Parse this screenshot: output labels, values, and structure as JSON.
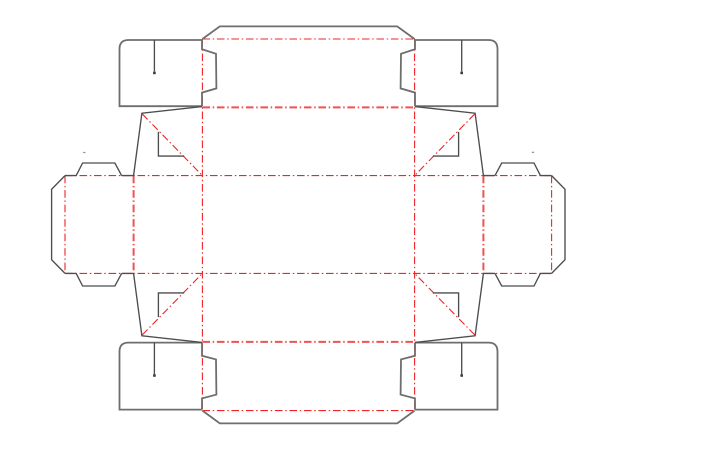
{
  "canvas": {
    "width": 720,
    "height": 464,
    "background": "#ffffff"
  },
  "styles": {
    "cut_color": "#4d4d4d",
    "cut_width": 1.35,
    "heavy_cut_color": "#6e6e6e",
    "heavy_cut_width": 1.8,
    "fold_color": "#f02427",
    "fold_width": 1.1,
    "fold_bold_width": 2.0,
    "fold_bold_opacity": 0.8,
    "fold_dash": "7.6 2.7 1.5 2.7",
    "dot_color": "#3a3a3a",
    "mark_color": "#8a8a8a"
  },
  "dieline": {
    "cut_paths": [
      {
        "name": "top-lid-flap",
        "heavy": true,
        "d": "M 202.4 39 L 219.8 26.4 L 397.2 26.4 L 414.6 39"
      },
      {
        "name": "bottom-lid-flap",
        "heavy": true,
        "d": "M 202.4 410.6 L 219.8 423.4 L 397.2 423.4 L 414.6 410.6"
      },
      {
        "name": "top-left-tuck-flap",
        "heavy": true,
        "d": "M 202 40 L 128.5 40 Q 119.5 40 119.5 49 L 119.5 106.2 L 202 106.2 M 202 40 L 202 49.2 L 216 53.8 L 216.4 88.4 L 202 92.6 L 202 106.2"
      },
      {
        "name": "top-left-flap-slit",
        "d": "M 154.4 40 L 154.4 71.4"
      },
      {
        "name": "top-right-tuck-flap",
        "heavy": true,
        "d": "M 415 40 L 488.5 40 Q 497.5 40 497.5 49 L 497.5 106.2 L 415 106.2 M 415 40 L 415 49.2 L 401 53.8 L 400.6 88.4 L 415 92.6 L 415 106.2"
      },
      {
        "name": "top-right-flap-slit",
        "d": "M 461.7 40 L 461.7 71.4"
      },
      {
        "name": "bottom-left-tuck-flap",
        "heavy": true,
        "d": "M 202 342.6 L 128.5 342.6 Q 119.5 342.6 119.5 351.6 L 119.5 409.6 L 202 409.6 M 202 342.6 L 202 355.8 L 216 359.4 L 216.4 394.6 L 202 398.4 L 202 409.6"
      },
      {
        "name": "bottom-left-flap-slit",
        "d": "M 154.4 342.6 L 154.4 374.2"
      },
      {
        "name": "bottom-right-tuck-flap",
        "heavy": true,
        "d": "M 415 342.6 L 488.5 342.6 Q 497.5 342.6 497.5 351.6 L 497.5 409.6 L 415 409.6 M 415 342.6 L 415 355.8 L 401 359.4 L 400.6 394.6 L 415 398.4 L 415 409.6"
      },
      {
        "name": "bottom-right-flap-slit",
        "d": "M 461.7 342.6 L 461.7 374.2"
      },
      {
        "name": "left-dust-flap",
        "d": "M 65 175.6 L 51.6 189.3 L 51.6 259.7 L 65 273.4 M 65 175.6 L 76.2 175.6 M 121.6 175.6 L 133.6 175.6 M 76.2 175.6 L 82.6 163 L 114.9 163 L 121.6 175.6 M 65 273.4 L 76.2 273.4 M 121.6 273.4 L 133.6 273.4 M 76.2 273.4 L 82.6 286 L 114.9 286 L 121.6 273.4"
      },
      {
        "name": "right-dust-flap",
        "d": "M 551.6 175.6 L 565 189.3 L 565 259.7 L 551.6 273.4 M 551.6 175.6 L 540.4 175.6 M 495 175.6 L 483 175.6 M 540.4 175.6 L 534 163 L 501.7 163 L 495 175.6 M 551.6 273.4 L 540.4 273.4 M 495 273.4 L 483 273.4 M 540.4 273.4 L 534 286 L 501.7 286 L 495 273.4"
      },
      {
        "name": "top-left-gusset",
        "d": "M 202 106.6 L 141.9 113.2 L 133.6 175.4 M 158.4 131.9 L 158.4 156.1 L 184.2 156.1"
      },
      {
        "name": "top-right-gusset",
        "d": "M 415 106.6 L 475.1 113.2 L 483.4 175.4 M 458.6 131.9 L 458.6 156.1 L 432.8 156.1"
      },
      {
        "name": "bottom-left-gusset",
        "d": "M 202 342.4 L 141.9 335.8 L 133.6 273.6 M 158.4 317.1 L 158.4 292.9 L 184.2 292.9"
      },
      {
        "name": "bottom-right-gusset",
        "d": "M 415 342.4 L 475.1 335.8 L 483.4 273.6 M 458.6 317.1 L 458.6 292.9 L 432.8 292.9"
      }
    ],
    "fold_lines": [
      {
        "name": "fold-top-lid",
        "x1": 202.4,
        "y1": 39,
        "x2": 414.6,
        "y2": 39,
        "bold": false
      },
      {
        "name": "fold-top-panel",
        "x1": 202.4,
        "y1": 107.4,
        "x2": 414.6,
        "y2": 107.4,
        "bold": true
      },
      {
        "name": "fold-upper-horizontal",
        "x1": 65,
        "y1": 175.6,
        "x2": 551.6,
        "y2": 175.6,
        "bold": false
      },
      {
        "name": "fold-lower-horizontal",
        "x1": 65,
        "y1": 273.4,
        "x2": 551.6,
        "y2": 273.4,
        "bold": false
      },
      {
        "name": "fold-bottom-panel",
        "x1": 202.4,
        "y1": 341.9,
        "x2": 414.6,
        "y2": 341.9,
        "bold": true
      },
      {
        "name": "fold-bottom-lid",
        "x1": 202.4,
        "y1": 410.6,
        "x2": 414.6,
        "y2": 410.6,
        "bold": false
      },
      {
        "name": "fold-left-panel-vertical",
        "x1": 202.4,
        "y1": 39,
        "x2": 202.4,
        "y2": 410.6,
        "bold": false
      },
      {
        "name": "fold-right-panel-vertical",
        "x1": 414.6,
        "y1": 39,
        "x2": 414.6,
        "y2": 410.6,
        "bold": false
      },
      {
        "name": "fold-left-side-vertical",
        "x1": 133.6,
        "y1": 175.6,
        "x2": 133.6,
        "y2": 273.4,
        "bold": true
      },
      {
        "name": "fold-right-side-vertical",
        "x1": 483.4,
        "y1": 175.6,
        "x2": 483.4,
        "y2": 273.4,
        "bold": true
      },
      {
        "name": "fold-left-glue-tab",
        "x1": 65,
        "y1": 175.6,
        "x2": 65,
        "y2": 273.4,
        "bold": false
      },
      {
        "name": "fold-right-glue-tab",
        "x1": 551.6,
        "y1": 175.6,
        "x2": 551.6,
        "y2": 273.4,
        "bold": false
      },
      {
        "name": "fold-gusset-diagonal-top-left",
        "x1": 142.3,
        "y1": 114,
        "x2": 202.1,
        "y2": 175.3,
        "bold": false
      },
      {
        "name": "fold-gusset-diagonal-top-right",
        "x1": 474.7,
        "y1": 114,
        "x2": 414.9,
        "y2": 175.3,
        "bold": false
      },
      {
        "name": "fold-gusset-diagonal-bottom-left",
        "x1": 142.3,
        "y1": 334.9,
        "x2": 202.1,
        "y2": 273.7,
        "bold": false
      },
      {
        "name": "fold-gusset-diagonal-bottom-right",
        "x1": 474.7,
        "y1": 334.9,
        "x2": 414.9,
        "y2": 273.7,
        "bold": false
      }
    ],
    "slit_dots": [
      {
        "name": "slit-end-dot-top-left",
        "x": 154.4,
        "y": 72.9,
        "size": 2.6
      },
      {
        "name": "slit-end-dot-top-right",
        "x": 461.7,
        "y": 72.9,
        "size": 2.6
      },
      {
        "name": "slit-end-dot-bottom-left",
        "x": 154.4,
        "y": 375.5,
        "size": 2.6
      },
      {
        "name": "slit-end-dot-bottom-right",
        "x": 461.7,
        "y": 375.5,
        "size": 2.6
      }
    ],
    "marks": [
      {
        "name": "registration-mark-left",
        "x": 84.3,
        "y": 152.5,
        "w": 2.2,
        "h": 1.2
      },
      {
        "name": "registration-mark-right",
        "x": 533,
        "y": 152.3,
        "w": 2.2,
        "h": 1.2
      }
    ]
  }
}
